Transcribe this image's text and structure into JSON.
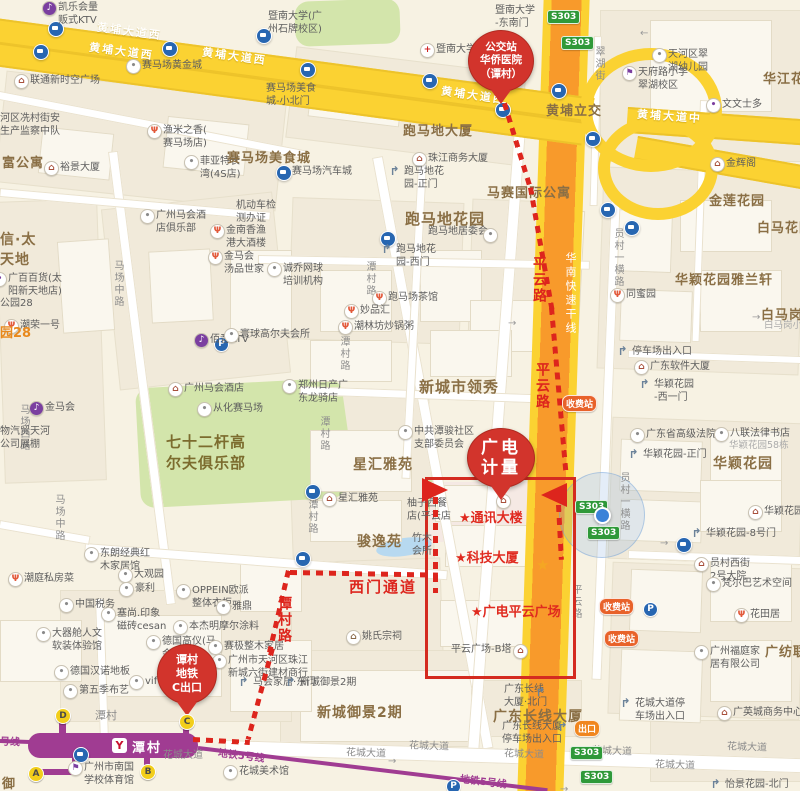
{
  "colors": {
    "route_red": "#DD251D",
    "balloon_red": "#D2342C",
    "area_brown": "#8A6F45",
    "metro_purple": "#A03C92",
    "road_yellow": "#FBD232",
    "expressway_orange": "#F89A2B",
    "badge_green": "#2F9939",
    "toll_orange": "#E8622A",
    "location_blue": "#3B82D8"
  },
  "balloons": [
    {
      "name": "bus-stop-balloon",
      "lines": [
        "公交站",
        "华侨医院",
        "（谭村）"
      ]
    },
    {
      "name": "destination-balloon",
      "lines": [
        "广电",
        "计量"
      ]
    },
    {
      "name": "metro-exit-balloon",
      "lines": [
        "谭村",
        "地铁",
        "C出口"
      ]
    }
  ],
  "metro": {
    "station": "潭村",
    "logo": "Y",
    "exits": [
      {
        "letter": "D",
        "x": 62,
        "y": 715
      },
      {
        "letter": "C",
        "x": 186,
        "y": 721
      },
      {
        "letter": "B",
        "x": 147,
        "y": 771
      },
      {
        "letter": "A",
        "x": 35,
        "y": 773
      }
    ]
  },
  "route": {
    "labels": [
      {
        "text": "平云路",
        "x": 529,
        "y": 256,
        "v": true
      },
      {
        "text": "平云路",
        "x": 532,
        "y": 362,
        "v": true
      },
      {
        "text": "谭村路",
        "x": 274,
        "y": 596,
        "v": true
      },
      {
        "text": "西门通道",
        "x": 349,
        "y": 576,
        "v": false,
        "size": 15
      }
    ],
    "star_labels": [
      {
        "text": "★通讯大楼",
        "x": 459,
        "y": 507
      },
      {
        "text": "★科技大厦",
        "x": 455,
        "y": 547
      },
      {
        "text": "★广电平云广场",
        "x": 471,
        "y": 601
      }
    ]
  },
  "areas": [
    {
      "text": "跑马地大厦",
      "x": 403,
      "y": 120,
      "size": 13
    },
    {
      "text": "马赛国际公寓",
      "x": 487,
      "y": 182,
      "size": 13
    },
    {
      "text": "跑马地花园",
      "x": 405,
      "y": 208,
      "size": 15
    },
    {
      "text": "赛马场美食城",
      "x": 227,
      "y": 147,
      "size": 13
    },
    {
      "text": "新城市领秀",
      "x": 419,
      "y": 376,
      "size": 15
    },
    {
      "text": "星汇雅苑",
      "x": 353,
      "y": 454,
      "size": 14
    },
    {
      "text": "骏逸苑",
      "x": 357,
      "y": 531,
      "size": 14
    },
    {
      "text": "七十二杆高\n尔夫俱乐部",
      "x": 166,
      "y": 431,
      "size": 15,
      "green": true
    },
    {
      "text": "华颖花园雅兰轩",
      "x": 675,
      "y": 269,
      "size": 13
    },
    {
      "text": "华颖花园",
      "x": 713,
      "y": 453,
      "size": 14
    },
    {
      "text": "白马花园",
      "x": 757,
      "y": 217,
      "size": 13
    },
    {
      "text": "白马岗小",
      "x": 761,
      "y": 304,
      "size": 13
    },
    {
      "text": "金莲花园",
      "x": 709,
      "y": 190,
      "size": 13
    },
    {
      "text": "华江花园",
      "x": 763,
      "y": 68,
      "size": 13
    },
    {
      "text": "黄埔立交",
      "x": 546,
      "y": 100,
      "size": 13
    },
    {
      "text": "新城御景2期",
      "x": 317,
      "y": 702,
      "size": 14
    },
    {
      "text": "广东长线大厦",
      "x": 493,
      "y": 706,
      "size": 14
    },
    {
      "text": "广纺联",
      "x": 765,
      "y": 641,
      "size": 13
    },
    {
      "text": "信·太\n天地",
      "x": 0,
      "y": 229,
      "size": 14
    },
    {
      "text": "富公寓",
      "x": 2,
      "y": 152,
      "size": 13
    },
    {
      "text": "御",
      "x": 2,
      "y": 773,
      "size": 13
    },
    {
      "text": "潭村",
      "x": 95,
      "y": 707,
      "size": 11,
      "gray": true
    }
  ],
  "orange_labels": [
    {
      "text": "园28",
      "x": 0,
      "y": 322
    }
  ],
  "gray_light": [
    {
      "text": "白马岗小区",
      "x": 764,
      "y": 320
    },
    {
      "text": "华颖花园58栋",
      "x": 729,
      "y": 440
    }
  ],
  "labels_plain": [
    {
      "text": "公园28",
      "x": 0,
      "y": 298
    },
    {
      "text": "暨南大学(广\n州石牌校区)",
      "x": 268,
      "y": 11
    },
    {
      "text": "暨南大学\n-东南门",
      "x": 495,
      "y": 5
    },
    {
      "text": "赛马场美食\n城-小北门",
      "x": 266,
      "y": 83
    },
    {
      "text": "机动车检\n测办证",
      "x": 236,
      "y": 200
    },
    {
      "text": "河区冼村街安\n生产监察中队",
      "x": 0,
      "y": 113
    },
    {
      "text": "物汽贸天河\n公司展棚",
      "x": 0,
      "y": 426
    },
    {
      "text": "柚子西餐\n店(平云店",
      "x": 407,
      "y": 498
    },
    {
      "text": "竹木\n会所",
      "x": 412,
      "y": 533
    },
    {
      "text": "平云广场-B塔",
      "x": 451,
      "y": 644
    }
  ],
  "pois": [
    {
      "t": "凯乐会量\n贩式KTV",
      "x": 58,
      "y": 2,
      "i": "ktv"
    },
    {
      "t": "联通新时空广场",
      "x": 30,
      "y": 75,
      "i": "building"
    },
    {
      "t": "裕景大厦",
      "x": 60,
      "y": 162,
      "i": "building"
    },
    {
      "t": "赛马场黄金城",
      "x": 142,
      "y": 60,
      "i": "generic"
    },
    {
      "t": "渔米之香(\n赛马场店)",
      "x": 163,
      "y": 125,
      "i": "restaurant"
    },
    {
      "t": "菲亚特长\n湾(4S店)",
      "x": 200,
      "y": 156,
      "i": "generic"
    },
    {
      "t": "赛马场汽车城",
      "x": 292,
      "y": 166,
      "i": "bus"
    },
    {
      "t": "暨南大学附属第一",
      "x": 436,
      "y": 44,
      "i": "hospital"
    },
    {
      "t": "珠江商务大厦",
      "x": 428,
      "y": 153,
      "i": "building"
    },
    {
      "t": "跑马地花\n园-正门",
      "x": 404,
      "y": 166,
      "i": "gate"
    },
    {
      "t": "跑马地居委会",
      "x": 428,
      "y": 226,
      "i": null
    },
    {
      "t": "跑马地花\n园-西门",
      "x": 396,
      "y": 244,
      "i": "gate"
    },
    {
      "t": "诚乔网球\n培训机构",
      "x": 283,
      "y": 263,
      "i": "generic"
    },
    {
      "t": "跑马场茶馆",
      "x": 388,
      "y": 292,
      "i": "restaurant"
    },
    {
      "t": "妙品汇",
      "x": 360,
      "y": 305,
      "i": "restaurant"
    },
    {
      "t": "潮林坊炒锅粥",
      "x": 354,
      "y": 321,
      "i": "restaurant"
    },
    {
      "t": "郑州日产广\n东龙骑店",
      "x": 298,
      "y": 380,
      "i": "generic"
    },
    {
      "t": "广州马会酒\n店俱乐部",
      "x": 156,
      "y": 210,
      "i": "generic"
    },
    {
      "t": "金南香渔\n港大酒楼",
      "x": 226,
      "y": 225,
      "i": "restaurant"
    },
    {
      "t": "金马会\n汤品世家",
      "x": 224,
      "y": 251,
      "i": "restaurant"
    },
    {
      "t": "广百百货(太\n阳新天地店)",
      "x": 8,
      "y": 273,
      "i": "shop"
    },
    {
      "t": "佰音KTV",
      "x": 210,
      "y": 334,
      "i": "ktv"
    },
    {
      "t": "金马会",
      "x": 45,
      "y": 402,
      "i": "ktv"
    },
    {
      "t": "从化赛马场",
      "x": 213,
      "y": 403,
      "i": "generic"
    },
    {
      "t": "寰球高尔夫会所",
      "x": 240,
      "y": 329,
      "i": "generic"
    },
    {
      "t": "广州马会酒店",
      "x": 184,
      "y": 383,
      "i": "building"
    },
    {
      "t": "潮荣一号",
      "x": 20,
      "y": 320,
      "i": "restaurant"
    },
    {
      "t": "潮庭私房菜",
      "x": 24,
      "y": 573,
      "i": "restaurant"
    },
    {
      "t": "东朗经典红\n木家居馆",
      "x": 100,
      "y": 548,
      "i": "generic"
    },
    {
      "t": "大观园",
      "x": 134,
      "y": 569,
      "i": "generic"
    },
    {
      "t": "豪利",
      "x": 135,
      "y": 583,
      "i": "generic"
    },
    {
      "t": "OPPEIN欧派\n整体衣柜",
      "x": 192,
      "y": 585,
      "i": "generic"
    },
    {
      "t": "中国税务",
      "x": 75,
      "y": 599,
      "i": "generic"
    },
    {
      "t": "塞尚.印象\n磁砖cesan",
      "x": 117,
      "y": 608,
      "i": "generic"
    },
    {
      "t": "本杰明摩尔涂料",
      "x": 189,
      "y": 621,
      "i": "generic"
    },
    {
      "t": "德国高仪(马\n会家居店)",
      "x": 162,
      "y": 636,
      "i": "generic"
    },
    {
      "t": "赛极整木家居",
      "x": 224,
      "y": 641,
      "i": "generic"
    },
    {
      "t": "雅鼎",
      "x": 232,
      "y": 601,
      "i": "generic"
    },
    {
      "t": "德国汉诺地板",
      "x": 70,
      "y": 666,
      "i": "generic"
    },
    {
      "t": "vif",
      "x": 145,
      "y": 676,
      "i": "generic"
    },
    {
      "t": "第五季布艺",
      "x": 79,
      "y": 685,
      "i": "generic"
    },
    {
      "t": "大器舱人文\n软装体验馆",
      "x": 52,
      "y": 628,
      "i": "generic"
    },
    {
      "t": "广州市天河区珠江\n新城六街建材商行",
      "x": 228,
      "y": 655,
      "i": "generic"
    },
    {
      "t": "马会家居·东门",
      "x": 253,
      "y": 677,
      "i": "gate"
    },
    {
      "t": "新城御景2期",
      "x": 300,
      "y": 677,
      "i": "gate"
    },
    {
      "t": "姚氏宗祠",
      "x": 362,
      "y": 631,
      "i": "temple"
    },
    {
      "t": "星汇雅苑",
      "x": 338,
      "y": 493,
      "i": "building"
    },
    {
      "t": "中共潭骏社区\n支部委员会",
      "x": 414,
      "y": 426,
      "i": "generic"
    },
    {
      "t": "天河区翠\n湖幼儿园",
      "x": 668,
      "y": 49,
      "i": "generic"
    },
    {
      "t": "天府路小学\n翠湖校区",
      "x": 638,
      "y": 67,
      "i": "school"
    },
    {
      "t": "文文士多",
      "x": 722,
      "y": 99,
      "i": "shop"
    },
    {
      "t": "金辉阁",
      "x": 726,
      "y": 158,
      "i": "building"
    },
    {
      "t": "同蜜园",
      "x": 626,
      "y": 289,
      "i": "restaurant"
    },
    {
      "t": "停车场出入口",
      "x": 632,
      "y": 346,
      "i": "gate"
    },
    {
      "t": "广东软件大厦",
      "x": 650,
      "y": 361,
      "i": "building"
    },
    {
      "t": "华颖花园\n-西一门",
      "x": 654,
      "y": 379,
      "i": "gate"
    },
    {
      "t": "广东省高级法院",
      "x": 646,
      "y": 429,
      "i": "generic"
    },
    {
      "t": "八联法律书店",
      "x": 730,
      "y": 428,
      "i": "generic"
    },
    {
      "t": "华颖花园-正门",
      "x": 643,
      "y": 449,
      "i": "gate"
    },
    {
      "t": "华颖花园",
      "x": 764,
      "y": 506,
      "i": "building"
    },
    {
      "t": "华颖花园-8号门",
      "x": 706,
      "y": 528,
      "i": "gate"
    },
    {
      "t": "员村西街\n2号大院",
      "x": 710,
      "y": 558,
      "i": "building"
    },
    {
      "t": "梵尔巴艺术空间",
      "x": 722,
      "y": 578,
      "i": "generic"
    },
    {
      "t": "花田居",
      "x": 750,
      "y": 609,
      "i": "restaurant"
    },
    {
      "t": "广州福庭家\n居有限公司",
      "x": 710,
      "y": 646,
      "i": "generic"
    },
    {
      "t": "广英城商务中心",
      "x": 733,
      "y": 707,
      "i": "building"
    },
    {
      "t": "花城大道停\n车场出入口",
      "x": 635,
      "y": 698,
      "i": "gate"
    },
    {
      "t": "怡景花园-北门",
      "x": 725,
      "y": 779,
      "i": "gate"
    },
    {
      "t": "花城美术馆",
      "x": 239,
      "y": 766,
      "i": "generic"
    },
    {
      "t": "广州市南国\n学校体育馆",
      "x": 84,
      "y": 762,
      "i": "school"
    },
    {
      "t": "广东长线\n大厦·北门",
      "x": 504,
      "y": 684,
      "i": null
    },
    {
      "t": "广东长线大厦\n停车场出入口",
      "x": 502,
      "y": 721,
      "i": null
    }
  ],
  "standalone_icons": [
    {
      "type": "building",
      "x": 496,
      "y": 494
    },
    {
      "type": "building",
      "x": 513,
      "y": 644
    },
    {
      "type": "gate",
      "x": 534,
      "y": 686
    },
    {
      "type": "gate",
      "x": 556,
      "y": 721
    },
    {
      "type": "generic",
      "x": 483,
      "y": 228
    }
  ],
  "road_labels": {
    "vertical_gray": [
      {
        "text": "马场中路",
        "x": 110,
        "y": 260
      },
      {
        "text": "马场中路",
        "x": 51,
        "y": 494
      },
      {
        "text": "马场西路",
        "x": 16,
        "y": 404
      },
      {
        "text": "潭村路",
        "x": 362,
        "y": 261
      },
      {
        "text": "潭村路",
        "x": 336,
        "y": 336
      },
      {
        "text": "潭村路",
        "x": 316,
        "y": 416
      },
      {
        "text": "潭村路",
        "x": 304,
        "y": 499
      },
      {
        "text": "员村一横路",
        "x": 610,
        "y": 228
      },
      {
        "text": "员村一横路",
        "x": 616,
        "y": 472
      },
      {
        "text": "翠湖街",
        "x": 591,
        "y": 46
      },
      {
        "text": "平云路",
        "x": 568,
        "y": 584
      }
    ],
    "horizontal_gray": [
      {
        "text": "花城大道",
        "x": 346,
        "y": 744,
        "r": 2
      },
      {
        "text": "花城大道",
        "x": 409,
        "y": 737,
        "r": 2
      },
      {
        "text": "花城大道",
        "x": 504,
        "y": 745,
        "r": 2
      },
      {
        "text": "花城大道",
        "x": 592,
        "y": 742,
        "r": 2
      },
      {
        "text": "花城大道",
        "x": 727,
        "y": 738,
        "r": 2
      },
      {
        "text": "花城大道",
        "x": 655,
        "y": 756,
        "r": 2
      },
      {
        "text": "花城大道",
        "x": 163,
        "y": 746,
        "r": 0
      }
    ],
    "yellow": [
      {
        "text": "黄埔大道西",
        "x": 97,
        "y": 23,
        "r": 7.5
      },
      {
        "text": "黄埔大道西",
        "x": 89,
        "y": 43,
        "r": 7.5
      },
      {
        "text": "黄埔大道西",
        "x": 202,
        "y": 48,
        "r": 7.5
      },
      {
        "text": "黄埔大道西",
        "x": 441,
        "y": 87,
        "r": 8
      },
      {
        "text": "黄埔大道中",
        "x": 637,
        "y": 108,
        "r": 4
      }
    ],
    "expressway": [
      {
        "text": "华南快速干线",
        "x": 562,
        "y": 252
      }
    ],
    "metro": [
      {
        "text": "地铁5号线",
        "x": 218,
        "y": 747,
        "r": 7
      },
      {
        "text": "地铁5号线",
        "x": 460,
        "y": 773,
        "r": 7
      },
      {
        "text": "号线",
        "x": 0,
        "y": 733,
        "r": 2
      }
    ]
  },
  "badges": {
    "s303": {
      "text": "S303",
      "positions": [
        [
          547,
          10
        ],
        [
          561,
          36
        ],
        [
          575,
          500
        ],
        [
          587,
          526
        ],
        [
          570,
          746
        ],
        [
          580,
          770
        ]
      ]
    },
    "toll": {
      "text": "收费站",
      "positions": [
        [
          562,
          395
        ],
        [
          599,
          598
        ],
        [
          604,
          630
        ]
      ]
    },
    "exit": {
      "text": "出口",
      "positions": [
        [
          574,
          720
        ]
      ]
    }
  },
  "bus_stops": [
    [
      48,
      21
    ],
    [
      33,
      44
    ],
    [
      162,
      41
    ],
    [
      256,
      28
    ],
    [
      300,
      62
    ],
    [
      422,
      73
    ],
    [
      495,
      102
    ],
    [
      551,
      83
    ],
    [
      585,
      131
    ],
    [
      600,
      202
    ],
    [
      624,
      220
    ],
    [
      380,
      231
    ],
    [
      305,
      484
    ],
    [
      295,
      551
    ],
    [
      676,
      537
    ],
    [
      73,
      747
    ]
  ],
  "parking": [
    [
      214,
      337
    ],
    [
      643,
      602
    ],
    [
      446,
      779
    ]
  ],
  "arrows": [
    [
      640,
      28,
      "←"
    ],
    [
      752,
      312,
      "→"
    ],
    [
      508,
      318,
      "→"
    ],
    [
      226,
      770,
      "→"
    ],
    [
      388,
      756,
      "→"
    ],
    [
      660,
      538,
      "→"
    ],
    [
      560,
      784,
      "→"
    ]
  ],
  "landmark_star": {
    "x": 536,
    "y": 558
  },
  "location": {
    "x": 601,
    "y": 514
  }
}
